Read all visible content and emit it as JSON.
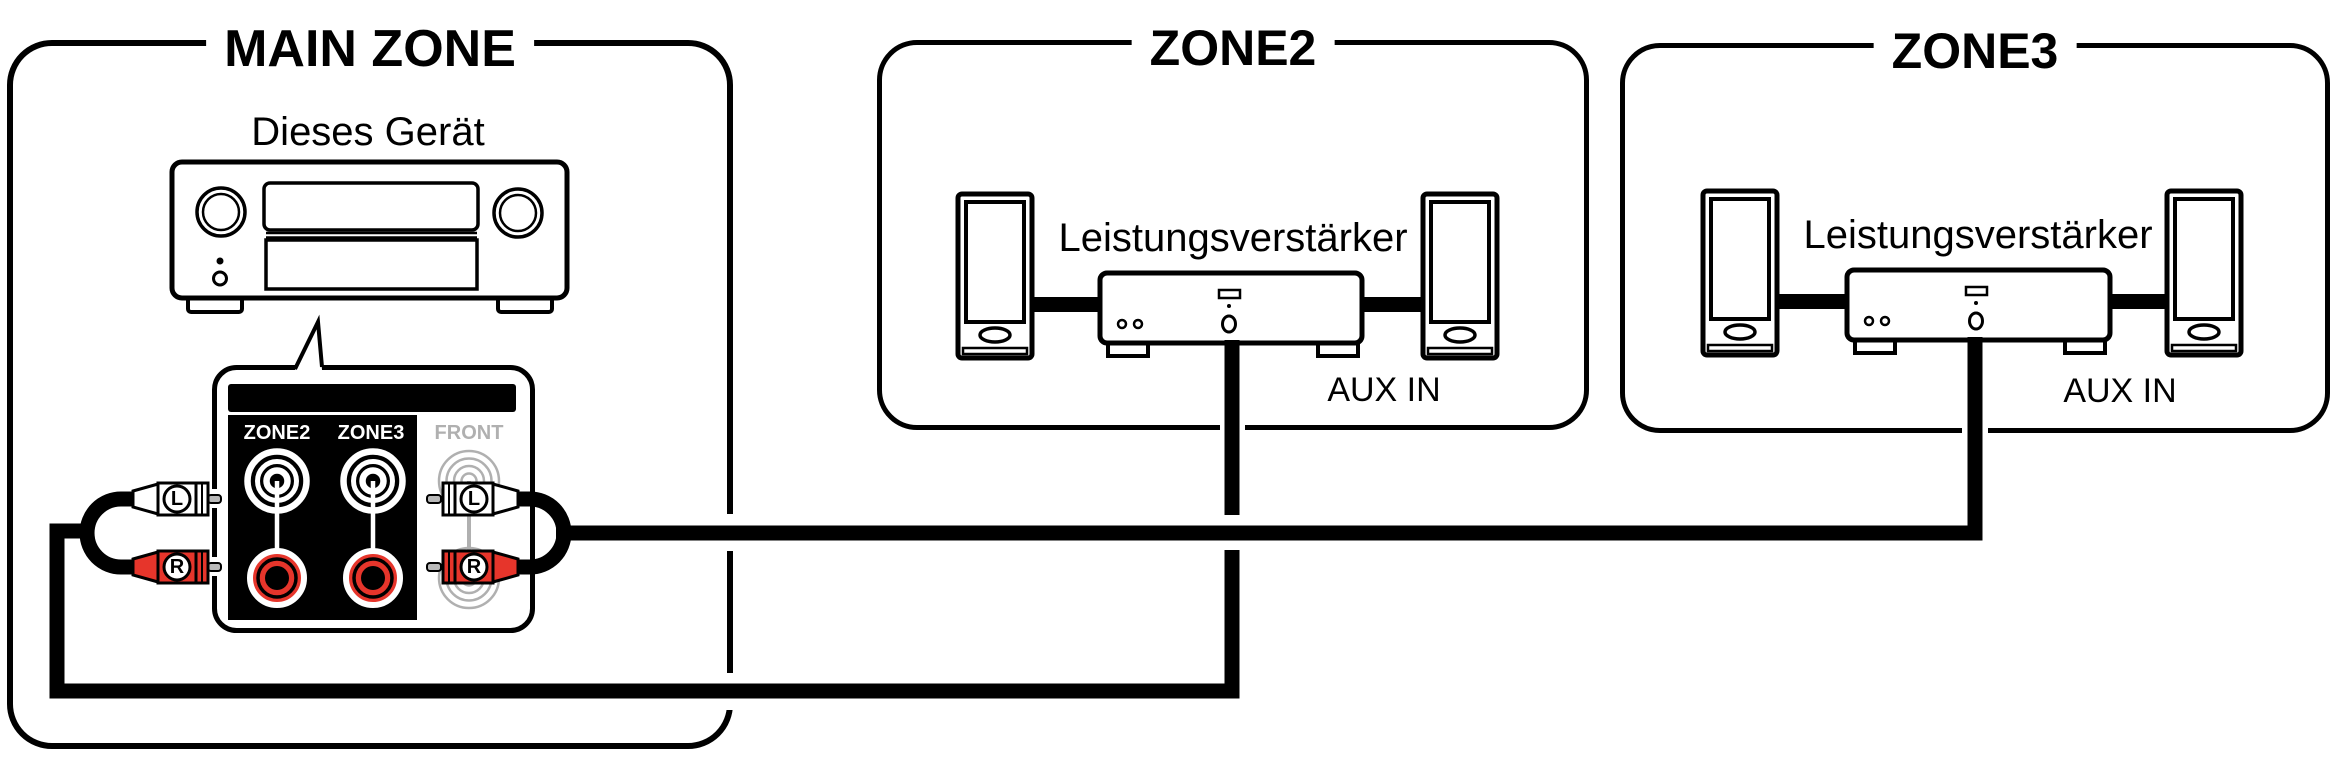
{
  "diagram": {
    "main_zone": {
      "title": "MAIN ZONE",
      "device_label": "Dieses Gerät",
      "rear_panel": {
        "columns": [
          {
            "label": "ZONE2"
          },
          {
            "label": "ZONE3"
          },
          {
            "label": "FRONT"
          }
        ],
        "plug_left_label": "L",
        "plug_right_label": "R"
      }
    },
    "zone2": {
      "title": "ZONE2",
      "amplifier_label": "Leistungsverstärker",
      "input_label": "AUX IN"
    },
    "zone3": {
      "title": "ZONE3",
      "amplifier_label": "Leistungsverstärker",
      "input_label": "AUX IN"
    }
  },
  "colors": {
    "line": "#000000",
    "rca_red": "#e6352b",
    "inactive_gray": "#b0b0b0",
    "pin_gray": "#b9b9b9"
  }
}
